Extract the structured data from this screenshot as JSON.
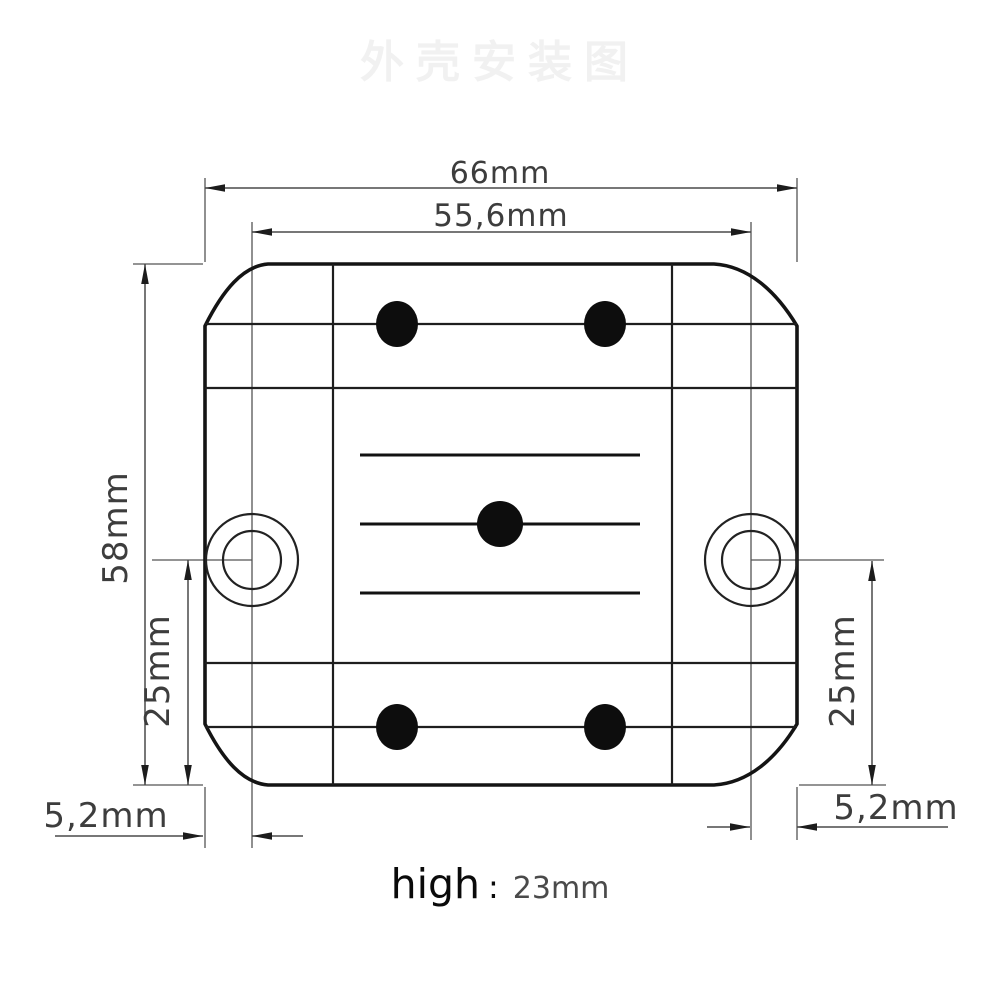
{
  "watermark": {
    "text": "外壳安装图"
  },
  "drawing": {
    "dims": {
      "width_overall": "66mm",
      "hole_spacing": "55,6mm",
      "height_overall": "58mm",
      "hole_offset_left": "25mm",
      "hole_offset_right": "25mm",
      "edge_offset_left": "5,2mm",
      "edge_offset_right": "5,2mm"
    }
  },
  "footer": {
    "label": "high",
    "separator": ":",
    "value": "23mm"
  }
}
